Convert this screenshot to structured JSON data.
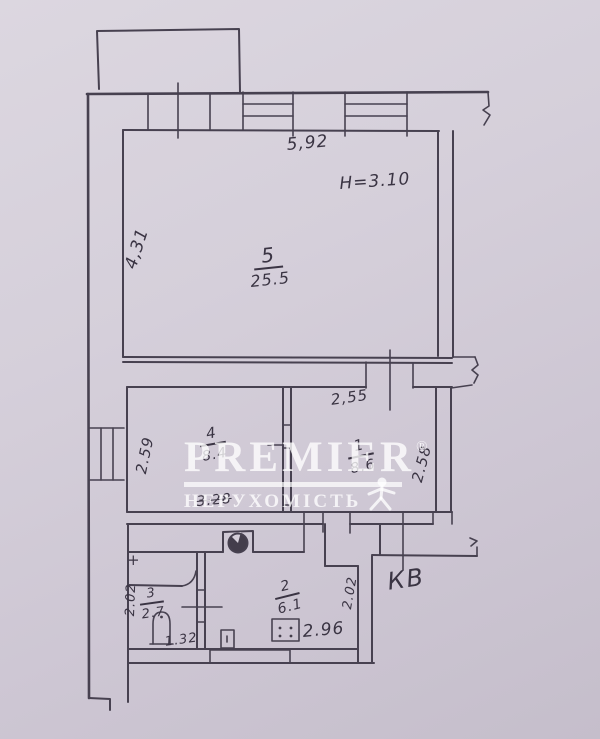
{
  "plan": {
    "rooms": [
      {
        "number": "5",
        "area": "25.5"
      },
      {
        "number": "4",
        "area": "8.4"
      },
      {
        "number": "1",
        "area": "8.6"
      },
      {
        "number": "3",
        "area": "2.7"
      },
      {
        "number": "2",
        "area": "6.1"
      }
    ],
    "dims": {
      "top_width": "5,92",
      "ceiling_height": "H=3.10",
      "room5_depth": "4,31",
      "room4_left": "2.59",
      "room1_top": "2,55",
      "room1_right": "2.58",
      "room4_bottom": "3.28",
      "kitchen_width": "2.96",
      "kitchen_right": "2.02",
      "bath_left": "2.02",
      "bath_bottom": "1.32"
    },
    "annotations": {
      "kv": "КВ",
      "plus_mark": "+"
    }
  },
  "watermark": {
    "brand": "PREMIER",
    "reg": "®",
    "subtitle": "НЕРУХОМІСТЬ"
  },
  "colors": {
    "paper": "#d5cfda",
    "ink": "#474150",
    "watermark": "#ffffff"
  }
}
